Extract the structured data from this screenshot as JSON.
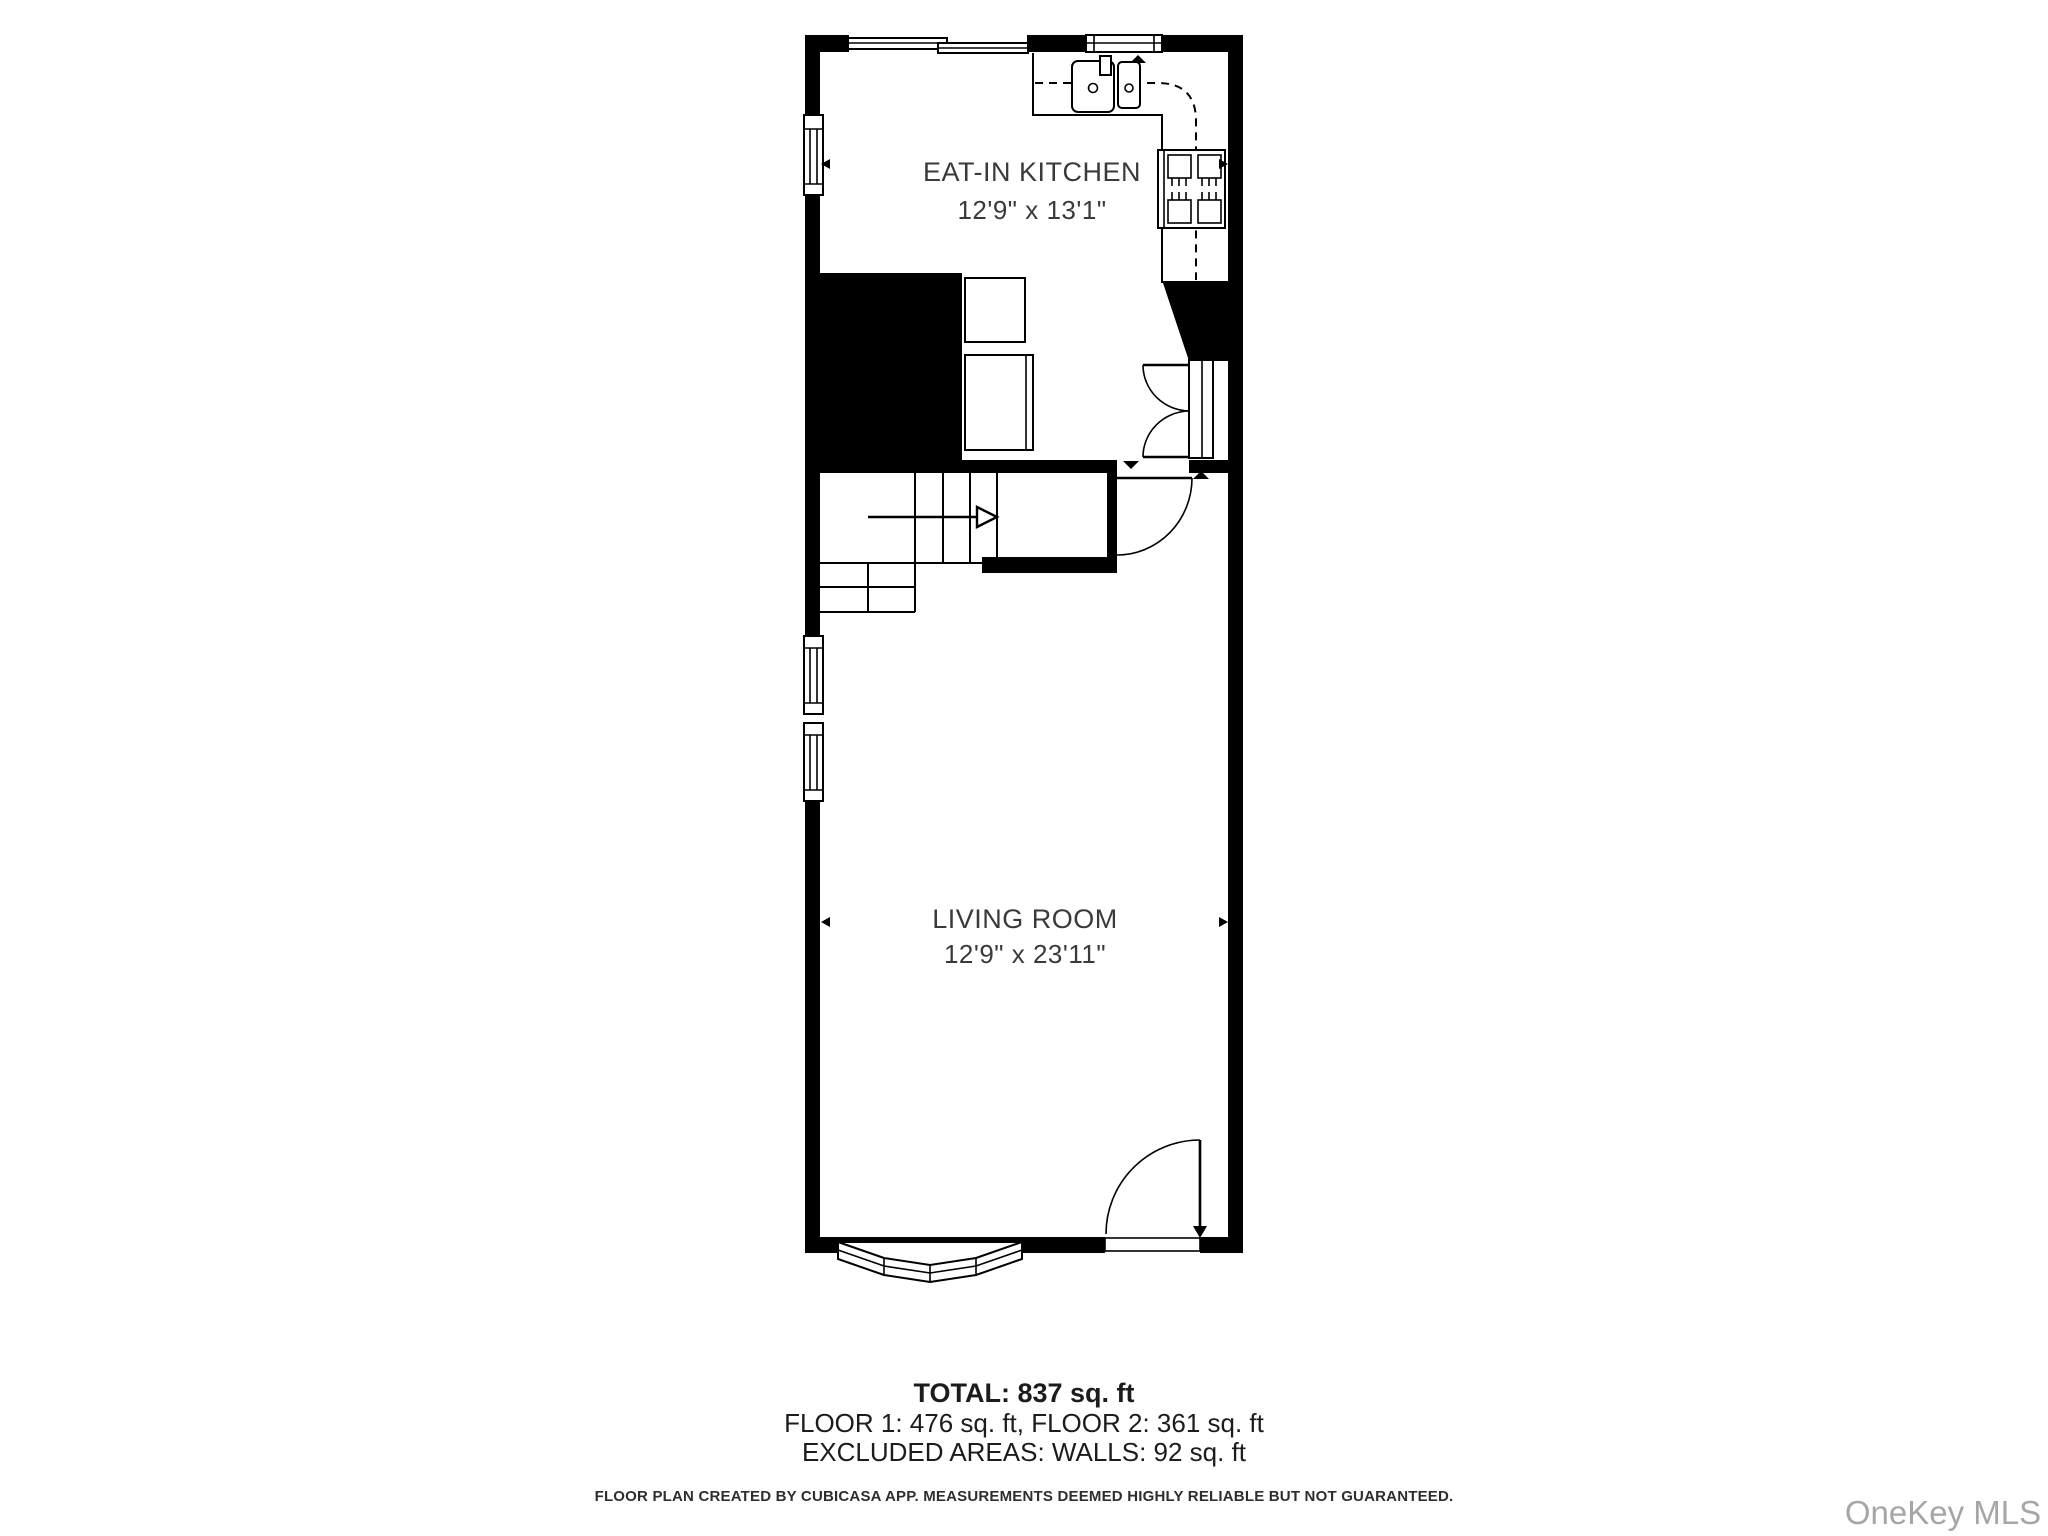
{
  "floor_plan": {
    "rooms": [
      {
        "name": "EAT-IN KITCHEN",
        "dimensions": "12'9\" x 13'1\""
      },
      {
        "name": "LIVING ROOM",
        "dimensions": "12'9\" x 23'11\""
      }
    ],
    "summary": {
      "total": "TOTAL: 837 sq. ft",
      "floors": "FLOOR 1: 476 sq. ft, FLOOR 2: 361 sq. ft",
      "excluded": "EXCLUDED AREAS: WALLS: 92 sq. ft"
    },
    "disclaimer": "FLOOR PLAN CREATED BY CUBICASA APP. MEASUREMENTS DEEMED HIGHLY RELIABLE BUT NOT GUARANTEED.",
    "watermark": "OneKey MLS",
    "icons": {
      "stair_arrow": "up-direction-arrow",
      "measure_arrows": "wall-to-wall-measure-arrows",
      "level_markers": "threshold-level-markers"
    },
    "colors": {
      "walls": "#000000",
      "background": "#ffffff",
      "label_text": "#3a3a3a",
      "summary_text": "#1c1c1c",
      "watermark": "#a6a6a6"
    }
  }
}
